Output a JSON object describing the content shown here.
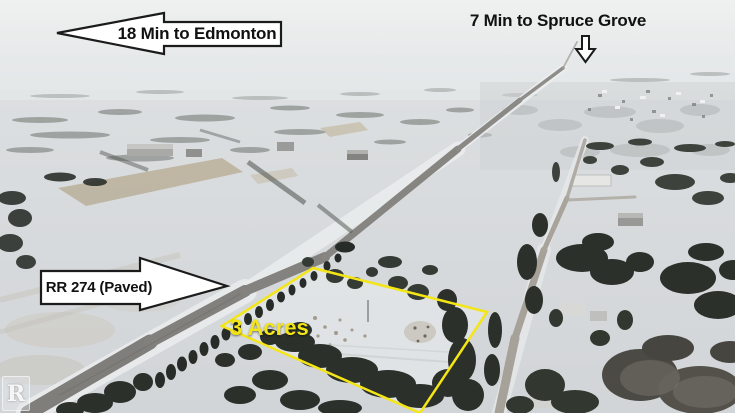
{
  "annotations": {
    "edmonton": {
      "label": "18 Min to Edmonton",
      "arrow_direction": "left"
    },
    "spruce_grove": {
      "label": "7 Min to Spruce Grove",
      "arrow_direction": "down"
    },
    "road": {
      "label": "RR 274 (Paved)",
      "arrow_direction": "right"
    },
    "lot": {
      "label": "3 Acres"
    },
    "watermark": {
      "label": "R"
    }
  },
  "colors": {
    "boundary_yellow": "#f3e516",
    "arrow_fill": "#ffffff",
    "arrow_outline": "#1b1b1b",
    "label_text": "#111111"
  },
  "scene": {
    "description": "Winter aerial photo: snow-covered rural fields, paved highway RR 274 running toward the horizon, tree-lined 3 acre lot outlined in yellow, acreages and Spruce Grove in the distance"
  }
}
